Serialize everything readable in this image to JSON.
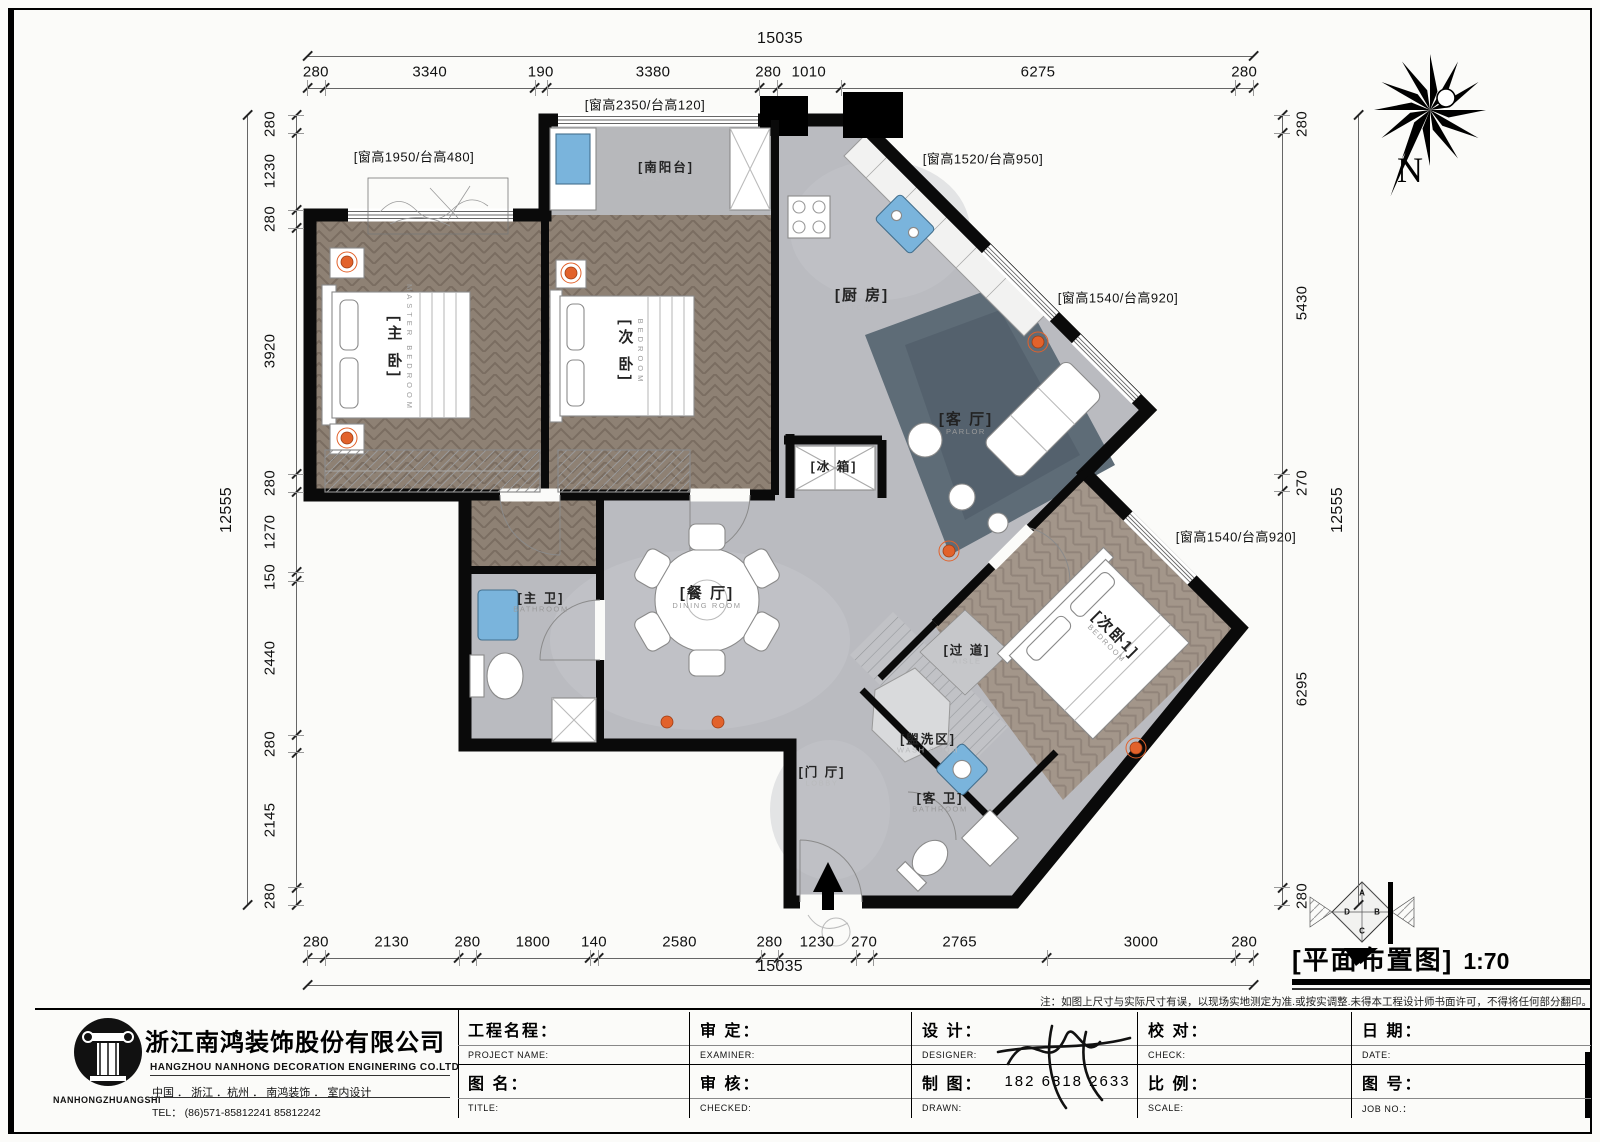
{
  "page": {
    "title_drawing": "[平面布置图]",
    "scale": "1:70",
    "north_label": "N",
    "note": "注：如图上尺寸与实际尺寸有误，以现场实地测定为准.或按实调整.未得本工程设计师书面许可，不得将任何部分翻印。"
  },
  "dimensions": {
    "top": {
      "total": "15035",
      "segments": [
        "280",
        "3340",
        "190",
        "3380",
        "280",
        "1010",
        "6275",
        "280"
      ]
    },
    "bottom": {
      "total": "15035",
      "segments": [
        "280",
        "2130",
        "280",
        "1800",
        "140",
        "2580",
        "280",
        "1230",
        "270",
        "2765",
        "3000",
        "280"
      ]
    },
    "left": {
      "total": "12555",
      "segments": [
        "280",
        "1230",
        "280",
        "3920",
        "280",
        "1270",
        "150",
        "2440",
        "280",
        "2145",
        "280"
      ]
    },
    "right": {
      "total": "12555",
      "segments": [
        "280",
        "5430",
        "270",
        "6295",
        "280"
      ]
    }
  },
  "plan": {
    "rooms": [
      {
        "id": "master-bedroom",
        "cn": "[主 卧]",
        "en": "MASTER  BEDROOM",
        "x": 399,
        "y": 348,
        "mode": "v"
      },
      {
        "id": "bedroom",
        "cn": "[次 卧]",
        "en": "BEDROOM",
        "x": 630,
        "y": 352,
        "mode": "v"
      },
      {
        "id": "balcony",
        "cn": "[南阳台]",
        "en": "BALCONY",
        "x": 666,
        "y": 172,
        "mode": "h",
        "faint": true,
        "small": true
      },
      {
        "id": "kitchen",
        "cn": "[厨 房]",
        "en": "KITCHEN",
        "x": 862,
        "y": 300,
        "mode": "h",
        "faint": true
      },
      {
        "id": "parlor",
        "cn": "[客 厅]",
        "en": "PARLOR",
        "x": 966,
        "y": 424,
        "mode": "h"
      },
      {
        "id": "dining-room",
        "cn": "[餐 厅]",
        "en": "DINING  ROOM",
        "x": 707,
        "y": 598,
        "mode": "h"
      },
      {
        "id": "master-bathroom",
        "cn": "[主 卫]",
        "en": "BATHROOM",
        "x": 541,
        "y": 603,
        "mode": "h",
        "small": true
      },
      {
        "id": "fridge",
        "cn": "[冰 箱]",
        "en": "",
        "x": 834,
        "y": 467,
        "mode": "h",
        "small": true
      },
      {
        "id": "bedroom-1",
        "cn": "[次卧1]",
        "en": "BEDROOM",
        "x": 1112,
        "y": 638,
        "mode": "d"
      },
      {
        "id": "aisle",
        "cn": "[过 道]",
        "en": "AISLE",
        "x": 967,
        "y": 655,
        "mode": "h",
        "faint": true,
        "small": true
      },
      {
        "id": "wash-room",
        "cn": "[盥洗区]",
        "en": "WASH  ROOM",
        "x": 928,
        "y": 744,
        "mode": "h",
        "faint": true,
        "small": true
      },
      {
        "id": "guest-bathroom",
        "cn": "[客 卫]",
        "en": "BATHROOM",
        "x": 940,
        "y": 803,
        "mode": "h",
        "small": true
      },
      {
        "id": "lobby",
        "cn": "[门 厅]",
        "en": "LOBBY",
        "x": 822,
        "y": 777,
        "mode": "h",
        "faint": true,
        "small": true
      }
    ],
    "window_notes": [
      {
        "text": "[窗高1950/台高480]",
        "x": 414,
        "y": 156
      },
      {
        "text": "[窗高2350/台高120]",
        "x": 645,
        "y": 104
      },
      {
        "text": "[窗高1520/台高950]",
        "x": 983,
        "y": 158
      },
      {
        "text": "[窗高1540/台高920]",
        "x": 1118,
        "y": 297
      },
      {
        "text": "[窗高1540/台高920]",
        "x": 1236,
        "y": 536
      }
    ]
  },
  "direction_symbol": {
    "letters": [
      "A",
      "B",
      "C",
      "D"
    ]
  },
  "company": {
    "logo_text": "NANHONGZHUANGSHI",
    "name_cn": "浙江南鸿装饰股份有限公司",
    "name_en": "HANGZHOU  NANHONG  DECORATION  ENGINERING  CO.LTD",
    "address": "中国 ． 浙江 ．杭州 ．      南鸿装饰 ． 室内设计",
    "tel": "TEL：  (86)571-85812241   85812242"
  },
  "title_block": {
    "cells": [
      {
        "id": "project-name",
        "cn": "工程名程：",
        "en": "PROJECT NAME:",
        "value": ""
      },
      {
        "id": "examiner",
        "cn": "审    定：",
        "en": "EXAMINER:",
        "value": ""
      },
      {
        "id": "designer",
        "cn": "设    计：",
        "en": "DESIGNER:",
        "value": ""
      },
      {
        "id": "check",
        "cn": "校    对：",
        "en": "CHECK:",
        "value": ""
      },
      {
        "id": "date",
        "cn": "日    期：",
        "en": "DATE:",
        "value": ""
      },
      {
        "id": "drawing-name",
        "cn": "图  名：",
        "en": "TITLE:",
        "value": ""
      },
      {
        "id": "checked",
        "cn": "审    核：",
        "en": "CHECKED:",
        "value": ""
      },
      {
        "id": "drawn",
        "cn": "制    图：",
        "en": "DRAWN:",
        "value": "182 6818 2633"
      },
      {
        "id": "scale",
        "cn": "比    例：",
        "en": "SCALE:",
        "value": ""
      },
      {
        "id": "job-no",
        "cn": "图    号：",
        "en": "JOB  NO.：",
        "value": ""
      }
    ]
  }
}
